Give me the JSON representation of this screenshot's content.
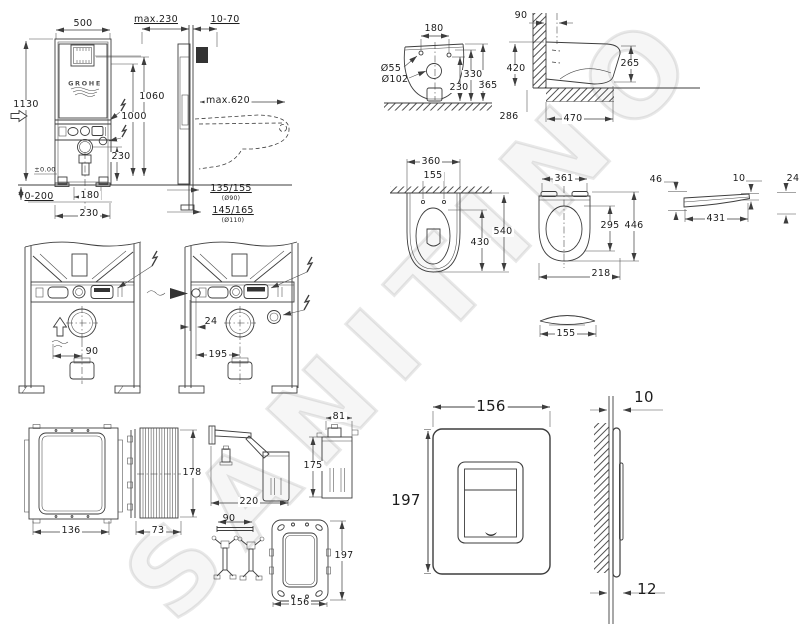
{
  "watermark": {
    "text": "SANITINO"
  },
  "colors": {
    "line": "#3d3d3d",
    "label": "#1c1c1c",
    "watermark": "rgba(0,0,0,0.09)"
  },
  "views": [
    "cistern-frame-front-view",
    "cistern-frame-side-view",
    "toilet-back-view",
    "toilet-side-view",
    "toilet-top-view",
    "seat-top-view",
    "seat-lid-side-view",
    "frame-variant-a",
    "frame-variant-b",
    "inspection-box-front",
    "inspection-box-side",
    "wall-bracket",
    "fill-valve-container",
    "mounting-rod-and-anchors",
    "mounting-frame",
    "flush-plate-front",
    "flush-plate-side"
  ],
  "labels": [
    {
      "n": "frame-width",
      "t": "500",
      "x": 83,
      "y": 24,
      "bg": 1
    },
    {
      "n": "frame-height",
      "t": "1130",
      "x": 26,
      "y": 105,
      "bg": 1
    },
    {
      "n": "frame-depth",
      "t": "max.230",
      "x": 156,
      "y": 20,
      "ul": 1
    },
    {
      "n": "wall-gap",
      "t": "10-70",
      "x": 225,
      "y": 20,
      "ul": 1
    },
    {
      "n": "actuator-height",
      "t": "1060",
      "x": 152,
      "y": 97,
      "bg": 1
    },
    {
      "n": "height-1000",
      "t": "1000",
      "x": 134,
      "y": 117,
      "bg": 1
    },
    {
      "n": "outlet-reach",
      "t": "max.620",
      "x": 228,
      "y": 101,
      "bg": 1
    },
    {
      "n": "drain-height",
      "t": "230",
      "x": 121,
      "y": 157,
      "bg": 1
    },
    {
      "n": "floor-level",
      "t": "±0.00",
      "x": 45,
      "y": 170,
      "fs": 6.5
    },
    {
      "n": "adjust-range",
      "t": "0-200",
      "x": 39,
      "y": 197,
      "ul": 1
    },
    {
      "n": "drain-offset",
      "t": "180",
      "x": 90,
      "y": 196,
      "bg": 1
    },
    {
      "n": "drain-offset-2",
      "t": "230",
      "x": 89,
      "y": 214,
      "bg": 1
    },
    {
      "n": "pipe-135-155",
      "t": "135/155",
      "x": 231,
      "y": 189,
      "ul": 1
    },
    {
      "n": "pipe-d90",
      "t": "(Ø90)",
      "x": 231,
      "y": 199,
      "fs": 6
    },
    {
      "n": "pipe-145-165",
      "t": "145/165",
      "x": 233,
      "y": 211,
      "ul": 1
    },
    {
      "n": "pipe-d110",
      "t": "(Ø110)",
      "x": 233,
      "y": 221,
      "fs": 6
    },
    {
      "n": "grohe-logo",
      "t": "GROHE",
      "x": 85,
      "y": 84,
      "fs": 6.5,
      "logo": 1
    },
    {
      "n": "wc-hole-spacing",
      "t": "180",
      "x": 434,
      "y": 29
    },
    {
      "n": "wc-inlet-dia",
      "t": "Ø55",
      "x": 391,
      "y": 69
    },
    {
      "n": "wc-outlet-dia",
      "t": "Ø102",
      "x": 395,
      "y": 80
    },
    {
      "n": "wc-height-330",
      "t": "330",
      "x": 473,
      "y": 75,
      "bg": 1
    },
    {
      "n": "wc-height-230",
      "t": "230",
      "x": 459,
      "y": 88,
      "bg": 1
    },
    {
      "n": "wc-height-365",
      "t": "365",
      "x": 488,
      "y": 86,
      "bg": 1
    },
    {
      "n": "wc-side-90",
      "t": "90",
      "x": 521,
      "y": 16
    },
    {
      "n": "wc-side-420",
      "t": "420",
      "x": 516,
      "y": 69,
      "bg": 1
    },
    {
      "n": "wc-side-265",
      "t": "265",
      "x": 630,
      "y": 64,
      "bg": 1
    },
    {
      "n": "wc-side-286",
      "t": "286",
      "x": 509,
      "y": 117
    },
    {
      "n": "wc-side-470",
      "t": "470",
      "x": 573,
      "y": 119,
      "bg": 1
    },
    {
      "n": "wc-top-360",
      "t": "360",
      "x": 431,
      "y": 162,
      "bg": 1
    },
    {
      "n": "wc-top-155",
      "t": "155",
      "x": 433,
      "y": 176,
      "bg": 1
    },
    {
      "n": "wc-top-540",
      "t": "540",
      "x": 503,
      "y": 232,
      "bg": 1
    },
    {
      "n": "wc-top-430",
      "t": "430",
      "x": 480,
      "y": 243,
      "bg": 1
    },
    {
      "n": "seat-361",
      "t": "361",
      "x": 564,
      "y": 179,
      "bg": 1
    },
    {
      "n": "seat-295",
      "t": "295",
      "x": 610,
      "y": 226,
      "bg": 1
    },
    {
      "n": "seat-446",
      "t": "446",
      "x": 634,
      "y": 226,
      "bg": 1
    },
    {
      "n": "seat-218",
      "t": "218",
      "x": 601,
      "y": 274,
      "bg": 1
    },
    {
      "n": "dome-155",
      "t": "155",
      "x": 566,
      "y": 334,
      "bg": 1
    },
    {
      "n": "lid-46",
      "t": "46",
      "x": 656,
      "y": 180
    },
    {
      "n": "lid-10",
      "t": "10",
      "x": 739,
      "y": 179
    },
    {
      "n": "lid-24",
      "t": "24",
      "x": 793,
      "y": 179
    },
    {
      "n": "lid-431",
      "t": "431",
      "x": 716,
      "y": 219,
      "bg": 1
    },
    {
      "n": "frame-a-90",
      "t": "90",
      "x": 92,
      "y": 352,
      "bg": 1
    },
    {
      "n": "frame-b-24",
      "t": "24",
      "x": 211,
      "y": 322
    },
    {
      "n": "frame-b-195",
      "t": "195",
      "x": 218,
      "y": 355,
      "bg": 1
    },
    {
      "n": "box-136",
      "t": "136",
      "x": 71,
      "y": 531,
      "bg": 1
    },
    {
      "n": "box-73",
      "t": "73",
      "x": 158,
      "y": 531,
      "bg": 1
    },
    {
      "n": "box-178",
      "t": "178",
      "x": 192,
      "y": 473,
      "bg": 1
    },
    {
      "n": "bracket-220",
      "t": "220",
      "x": 249,
      "y": 502,
      "bg": 1
    },
    {
      "n": "container-81",
      "t": "81",
      "x": 339,
      "y": 417,
      "bg": 1
    },
    {
      "n": "container-175",
      "t": "175",
      "x": 313,
      "y": 466,
      "bg": 1
    },
    {
      "n": "rod-90",
      "t": "90",
      "x": 229,
      "y": 519
    },
    {
      "n": "mount-frame-197",
      "t": "197",
      "x": 344,
      "y": 556,
      "bg": 1
    },
    {
      "n": "mount-frame-156",
      "t": "156",
      "x": 300,
      "y": 603,
      "bg": 1
    },
    {
      "n": "plate-156",
      "t": "156",
      "x": 491,
      "y": 407,
      "fs": 15,
      "bg": 1
    },
    {
      "n": "plate-197",
      "t": "197",
      "x": 406,
      "y": 501,
      "fs": 15,
      "bg": 1
    },
    {
      "n": "plate-10",
      "t": "10",
      "x": 644,
      "y": 398,
      "fs": 15
    },
    {
      "n": "plate-12",
      "t": "12",
      "x": 647,
      "y": 590,
      "fs": 15
    }
  ]
}
